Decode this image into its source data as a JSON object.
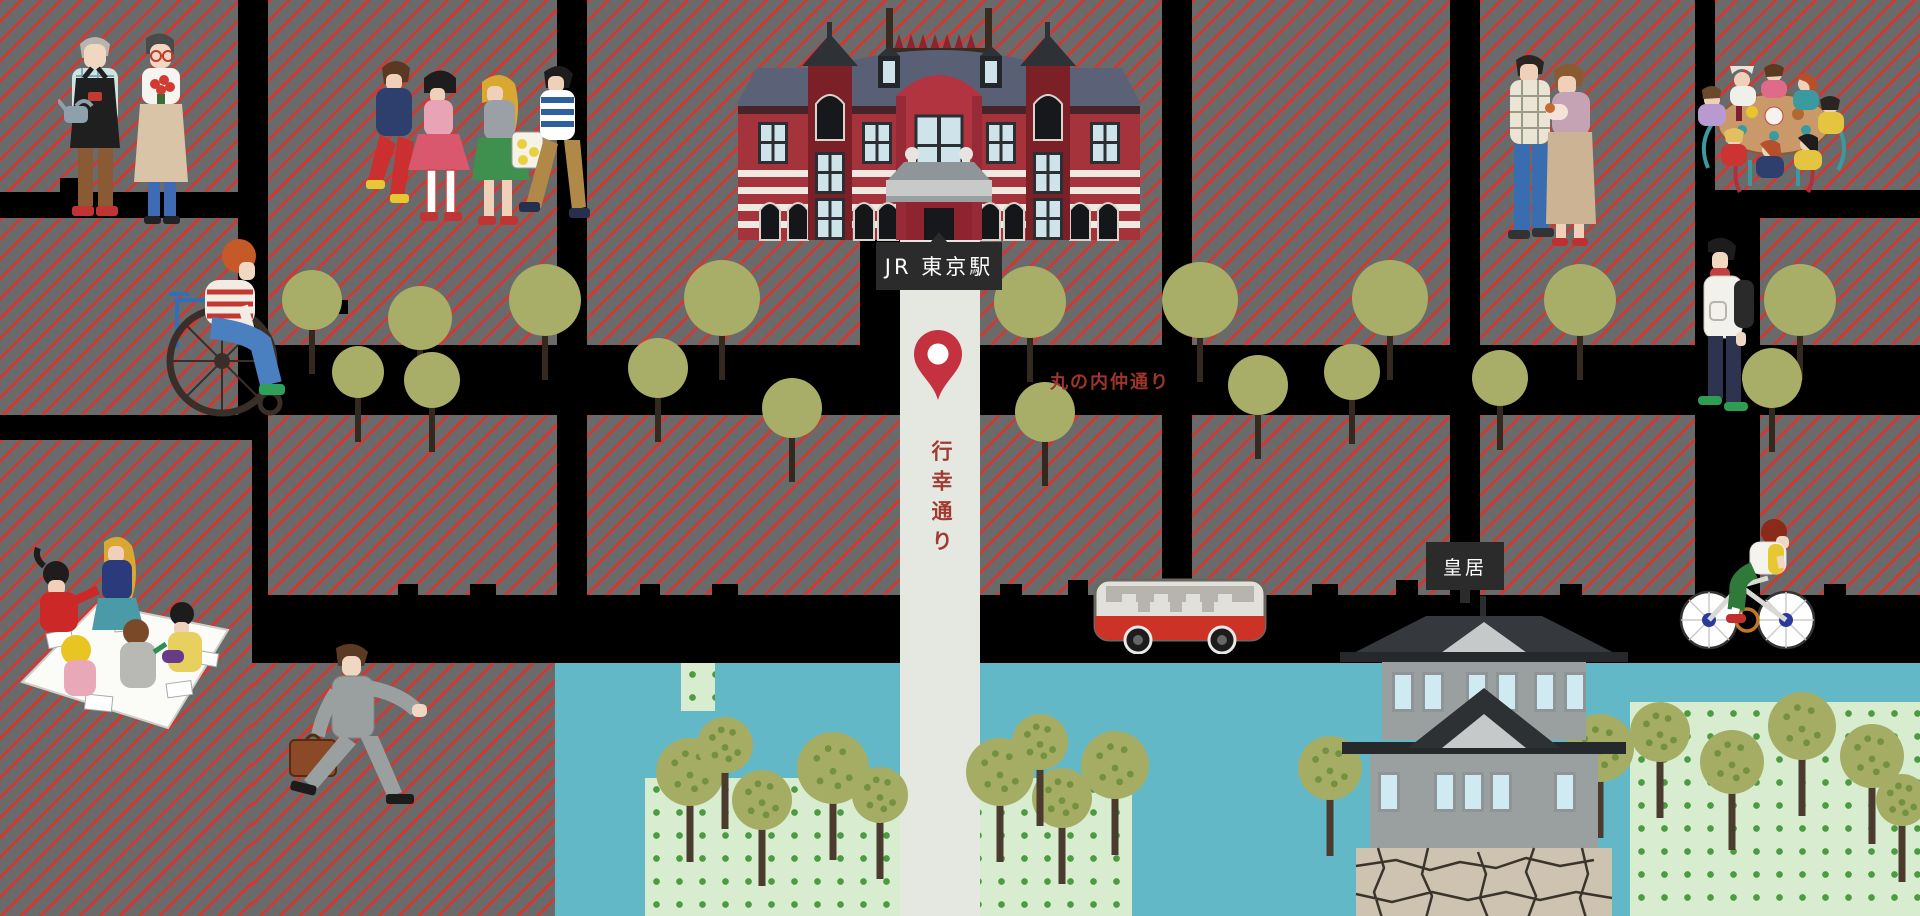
{
  "map": {
    "name": "Illustrated map of the Tokyo Station and Imperial Palace area",
    "labels": {
      "station": "JR 東京駅",
      "gyoko_street": "行幸通り",
      "naka_street": "丸の内仲通り",
      "palace": "皇居"
    },
    "landmarks": [
      {
        "name": "tokyo-station-building",
        "label": "JR 東京駅"
      },
      {
        "name": "imperial-palace-castle",
        "label": "皇居"
      },
      {
        "name": "location-pin",
        "street": "行幸通り"
      }
    ],
    "figures": [
      {
        "name": "elderly-gardener-couple",
        "desc": "older couple with watering can and flowers"
      },
      {
        "name": "wheelchair-person",
        "desc": "person in striped shirt using a wheelchair"
      },
      {
        "name": "shopping-group",
        "desc": "four people walking with shopping bag"
      },
      {
        "name": "family-with-baby",
        "desc": "couple holding a baby"
      },
      {
        "name": "party-table-group",
        "desc": "group of women around a table with food"
      },
      {
        "name": "backpack-man",
        "desc": "man in white jacket with backpack"
      },
      {
        "name": "picnic-group",
        "desc": "five people on a picnic sheet with papers"
      },
      {
        "name": "businessman-with-briefcase",
        "desc": "man in gray suit striding with briefcase"
      },
      {
        "name": "red-bus",
        "desc": "red and white bus"
      },
      {
        "name": "cyclist",
        "desc": "person riding a bicycle"
      }
    ],
    "colors": {
      "street_black": "#000000",
      "block_gray": "#6a6a6a",
      "block_stripe_red": "#e2302a",
      "avenue_light": "#e4e8e1",
      "pin_red": "#c4323f",
      "label_bg": "#2b2b2b",
      "label_text": "#ffffff",
      "street_name_red": "#a13a31",
      "water_teal": "#63b8c7",
      "park_green": "#d8ecd0",
      "park_dot_green": "#4b9b40",
      "tree_olive": "#a8ad68",
      "station_red": "#a5333b",
      "station_roof_slate": "#5b6278",
      "castle_gray": "#9aa0a0",
      "castle_roof_dark": "#2e3134",
      "stone_base": "#cdc3b0"
    }
  }
}
